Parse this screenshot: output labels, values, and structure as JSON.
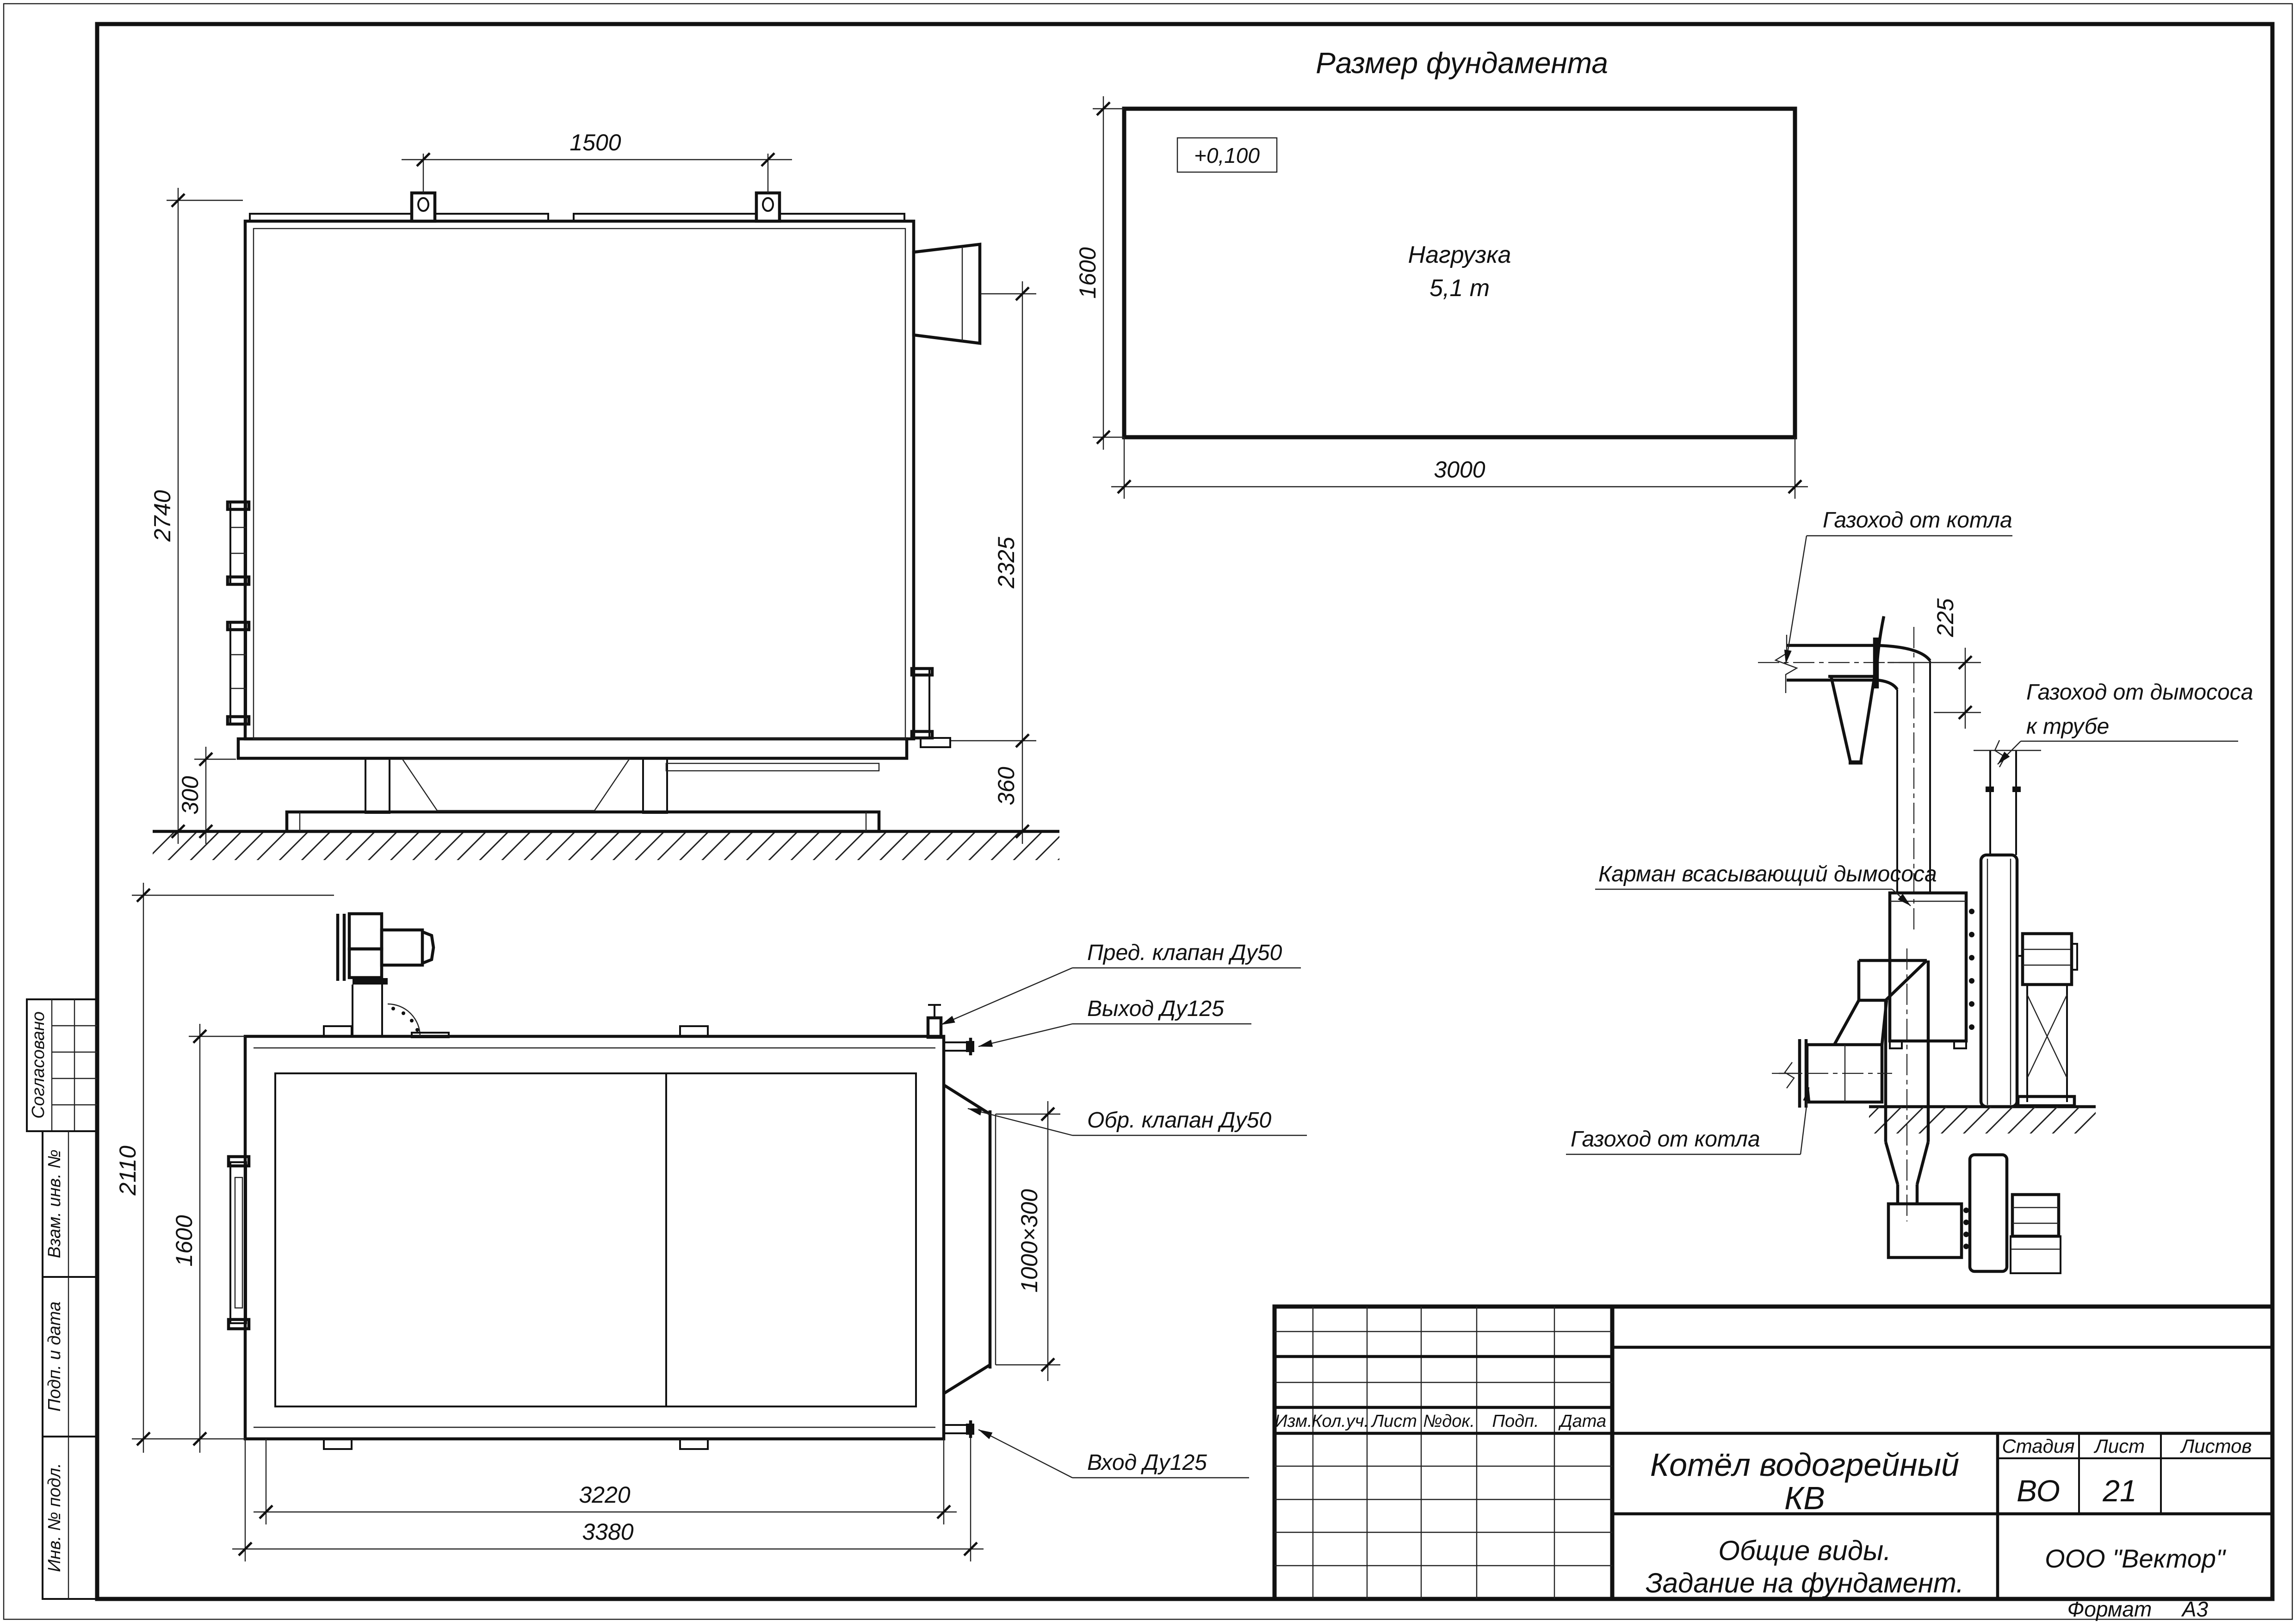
{
  "sheet": {
    "format_label": "Формат",
    "format_value": "А3"
  },
  "margin": {
    "agreed": "Согласовано",
    "replace_inv": "Взам. инв. №",
    "sign_date": "Подп. и дата",
    "inv_orig": "Инв. № подл."
  },
  "foundation": {
    "title": "Размер фундамента",
    "elevation": "+0,100",
    "load1": "Нагрузка",
    "load2": "5,1 т",
    "width": "3000",
    "height": "1600"
  },
  "side_view": {
    "lug_span": "1500",
    "height": "2740",
    "flue_height": "2325",
    "clearance": "300",
    "base_height": "360"
  },
  "plan_view": {
    "overall_height": "2110",
    "body_height": "1600",
    "inner_length": "3220",
    "overall_length": "3380",
    "duct_size": "1000×300",
    "safety_valve": "Пред. клапан Ду50",
    "outlet": "Выход Ду125",
    "check_valve": "Обр. клапан Ду50",
    "inlet": "Вход Ду125"
  },
  "flue_elevation": {
    "from_boiler": "Газоход от котла",
    "offset": "225",
    "to_stack1": "Газоход от дымососа",
    "to_stack2": "к трубе",
    "pocket": "Карман всасывающий дымососа"
  },
  "flue_plan": {
    "from_boiler": "Газоход от котла"
  },
  "title_block": {
    "rev_cols": [
      "Изм.",
      "Кол.уч.",
      "Лист",
      "№док.",
      "Подп.",
      "Дата"
    ],
    "title1": "Котёл водогрейный",
    "title2": "КВ",
    "stage_label": "Стадия",
    "sheet_label": "Лист",
    "sheets_label": "Листов",
    "stage": "ВО",
    "sheet": "21",
    "sheets": "",
    "sub1": "Общие виды.",
    "sub2": "Задание на фундамент.",
    "company": "ООО \"Вектор\""
  }
}
